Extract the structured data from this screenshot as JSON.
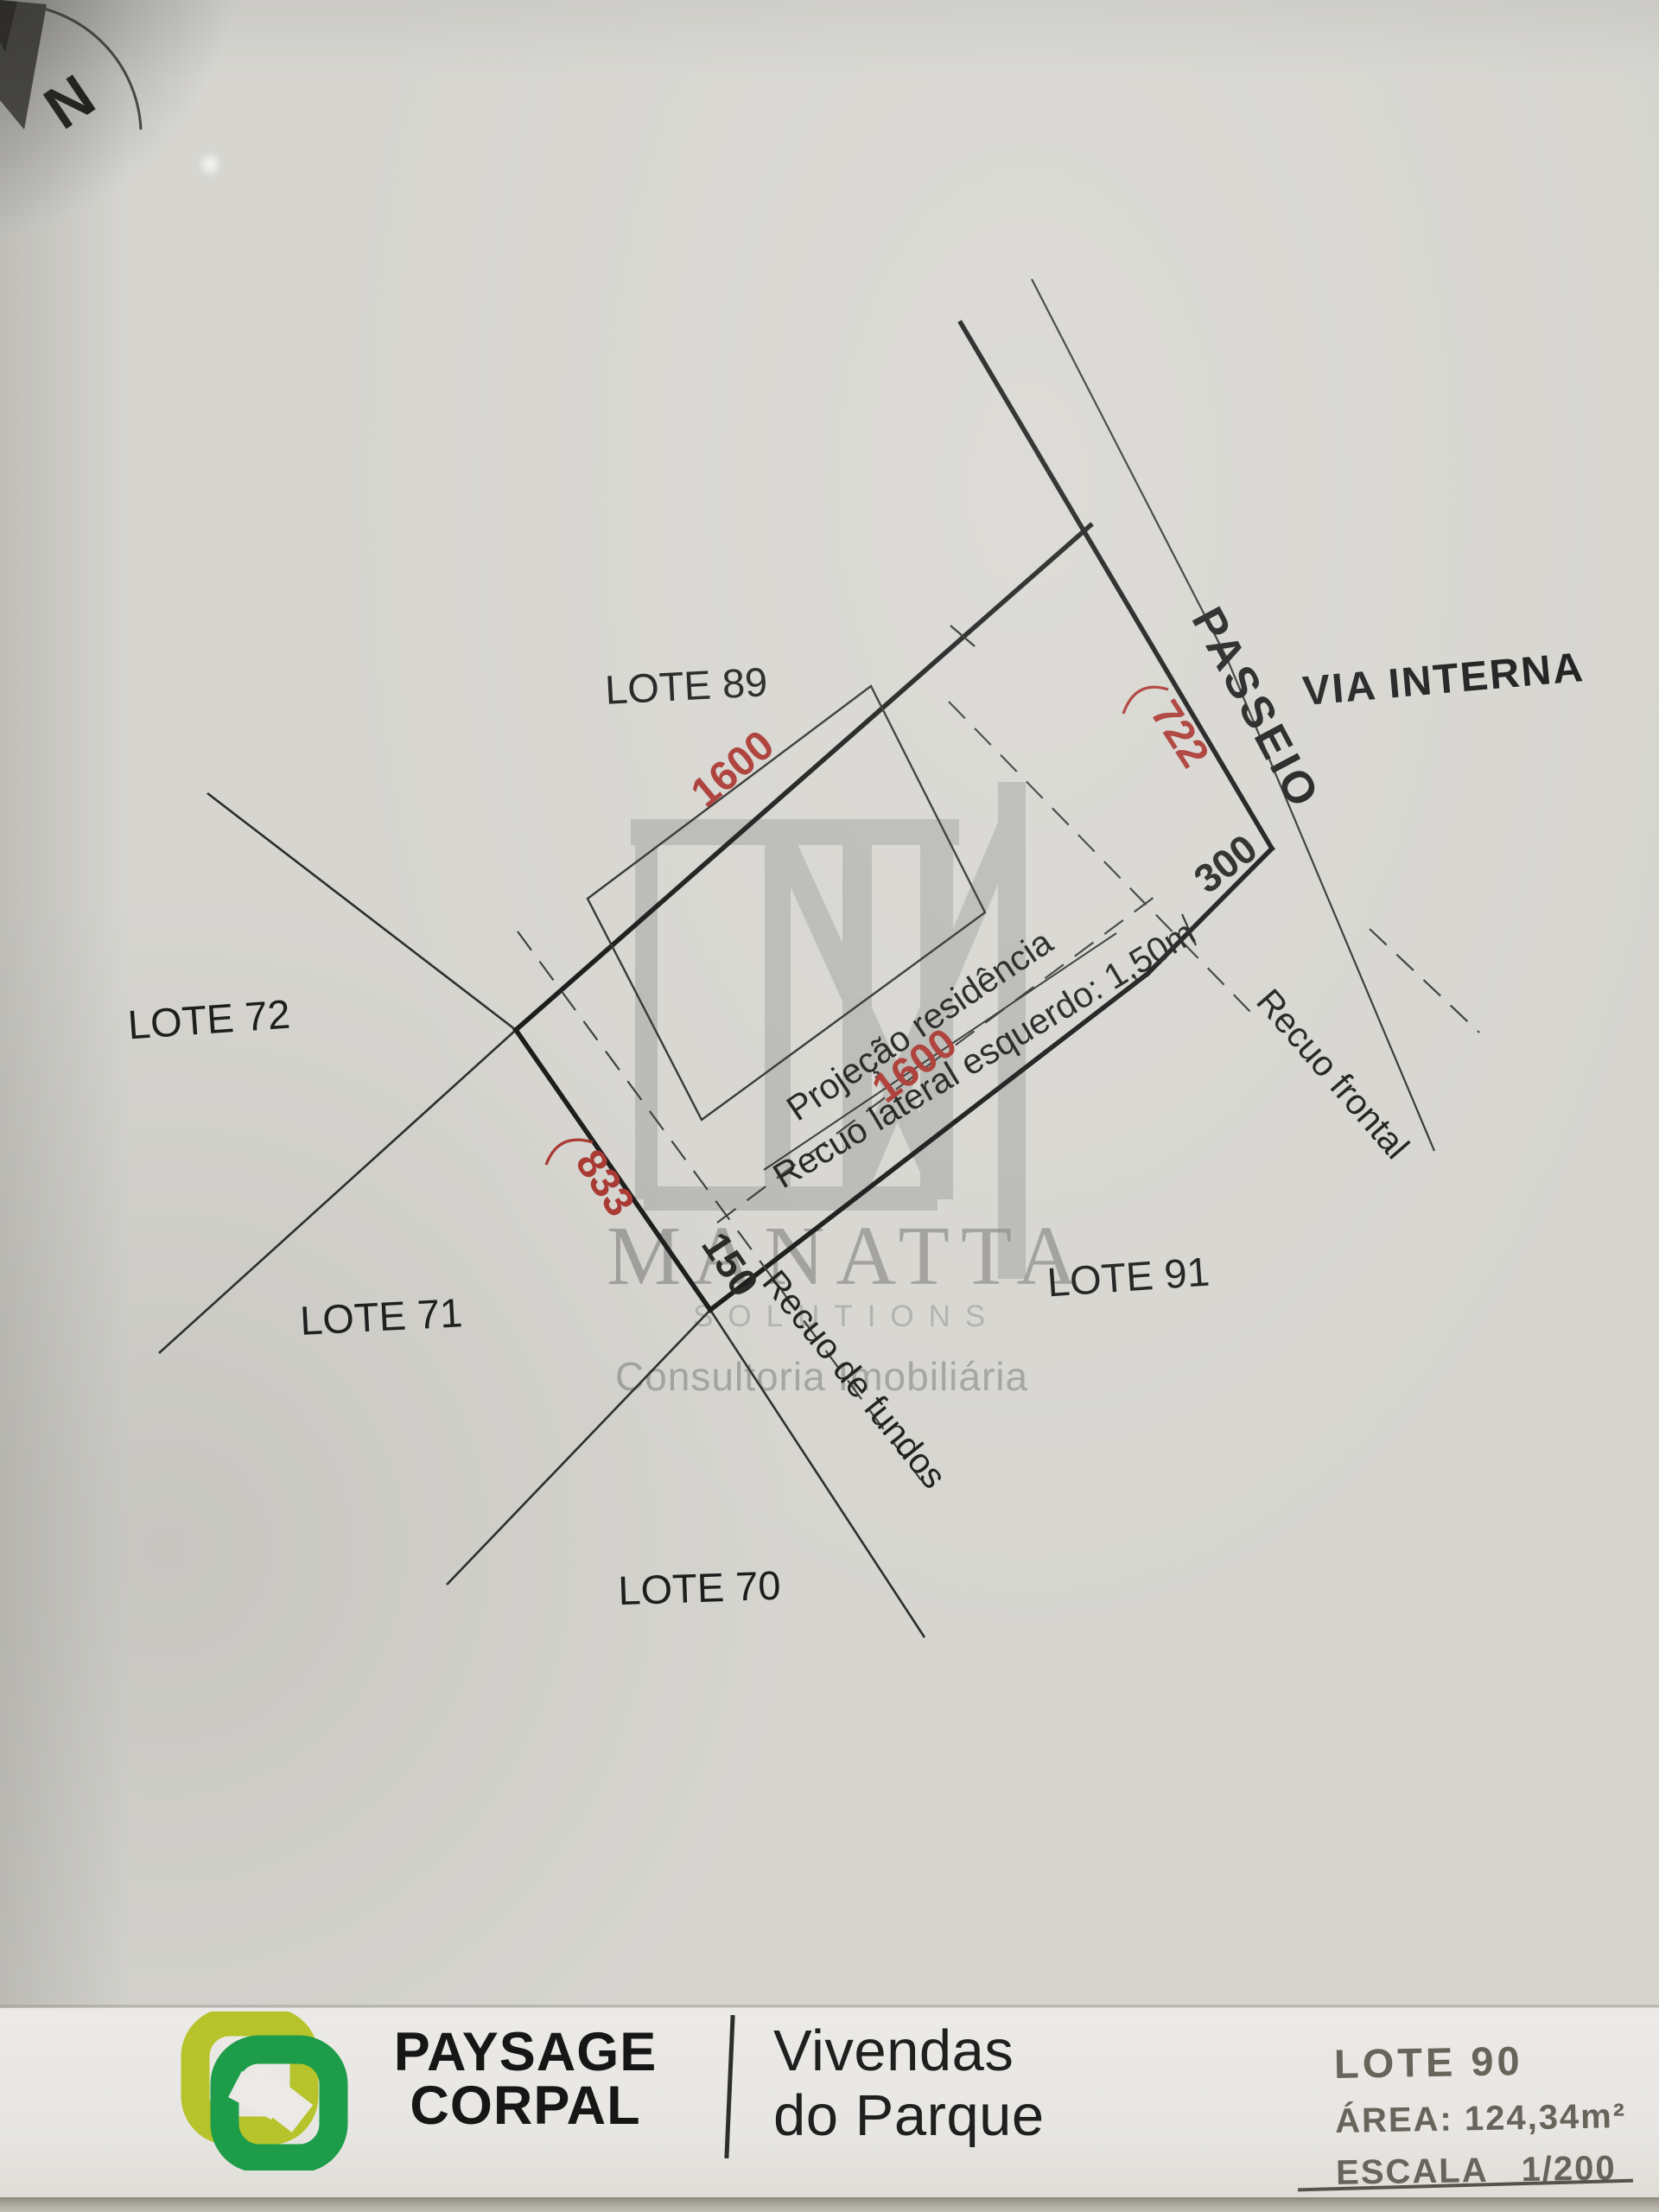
{
  "compass": {
    "north_label": "N"
  },
  "plan": {
    "lot_labels": {
      "lote89": "LOTE 89",
      "lote72": "LOTE 72",
      "lote71": "LOTE 71",
      "lote70": "LOTE 70",
      "lote91": "LOTE 91"
    },
    "street_labels": {
      "passeio": "PASSEIO",
      "via_interna": "VIA INTERNA"
    },
    "annotation_labels": {
      "projecao": "Projeção residência",
      "recuo_lateral": "Recuo lateral esquerdo: 1,50m",
      "recuo_frontal": "Recuo frontal",
      "recuo_fundos": "Recuo de fundos"
    },
    "dimensions": {
      "nw_side": "1600",
      "front_arc": "722",
      "se_side": "1600",
      "rear_arc": "833",
      "chamfer": "300",
      "rear_corner": "150"
    },
    "colors": {
      "dimension_red": "#a9342e",
      "ink": "#1c1c1c"
    }
  },
  "watermark": {
    "name": "MANATTA",
    "word2": "SOLUTIONS",
    "tagline": "Consultoria Imobiliária"
  },
  "footer": {
    "brand_top": "PAYSAGE",
    "brand_bottom": "CORPAL",
    "project_top": "Vivendas",
    "project_bottom": "do Parque",
    "lot_title": "LOTE 90",
    "area": "ÁREA: 124,34m²",
    "scale_word": "ESCALA",
    "scale_value": "1/200",
    "colors": {
      "brand_green": "#1d9c49",
      "brand_yellow": "#b6c32b",
      "muted_gray": "#67645c"
    }
  }
}
